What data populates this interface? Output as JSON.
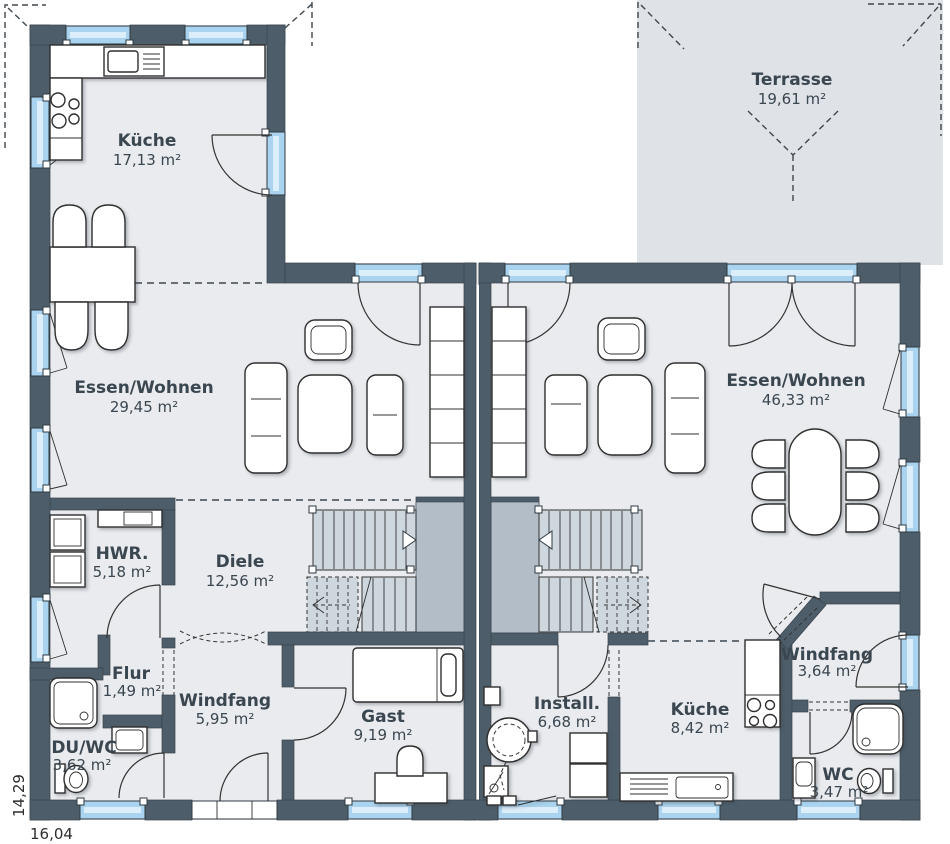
{
  "plan": {
    "title": "duplex-ground-floor-plan",
    "labels": {
      "kueche_left": {
        "name": "Küche",
        "area": "17,13 m²"
      },
      "terrasse": {
        "name": "Terrasse",
        "area": "19,61 m²"
      },
      "essen_left": {
        "name": "Essen/Wohnen",
        "area": "29,45 m²"
      },
      "essen_right": {
        "name": "Essen/Wohnen",
        "area": "46,33 m²"
      },
      "hwr": {
        "name": "HWR.",
        "area": "5,18 m²"
      },
      "diele": {
        "name": "Diele",
        "area": "12,56 m²"
      },
      "flur": {
        "name": "Flur",
        "area": "1,49 m²"
      },
      "windfang_left": {
        "name": "Windfang",
        "area": "5,95 m²"
      },
      "gast": {
        "name": "Gast",
        "area": "9,19 m²"
      },
      "du_wc": {
        "name": "DU/WC",
        "area": "3,62 m²"
      },
      "install": {
        "name": "Install.",
        "area": "6,68 m²"
      },
      "kueche_right": {
        "name": "Küche",
        "area": "8,42 m²"
      },
      "windfang_right": {
        "name": "Windfang",
        "area": "3,64 m²"
      },
      "wc": {
        "name": "WC",
        "area": "3,47 m²"
      }
    },
    "dimensions": {
      "bottom": "16,04",
      "left": "14,29"
    },
    "colors": {
      "wall": "#4d5e6a",
      "room_floor": "#e9ebee",
      "terrace": "#dfe2e6",
      "window_glass": "#a9d3ef",
      "stair_tread": "#cfd7de",
      "stair_shaft": "#b3bdc8",
      "label_text": "#3a4650"
    }
  }
}
